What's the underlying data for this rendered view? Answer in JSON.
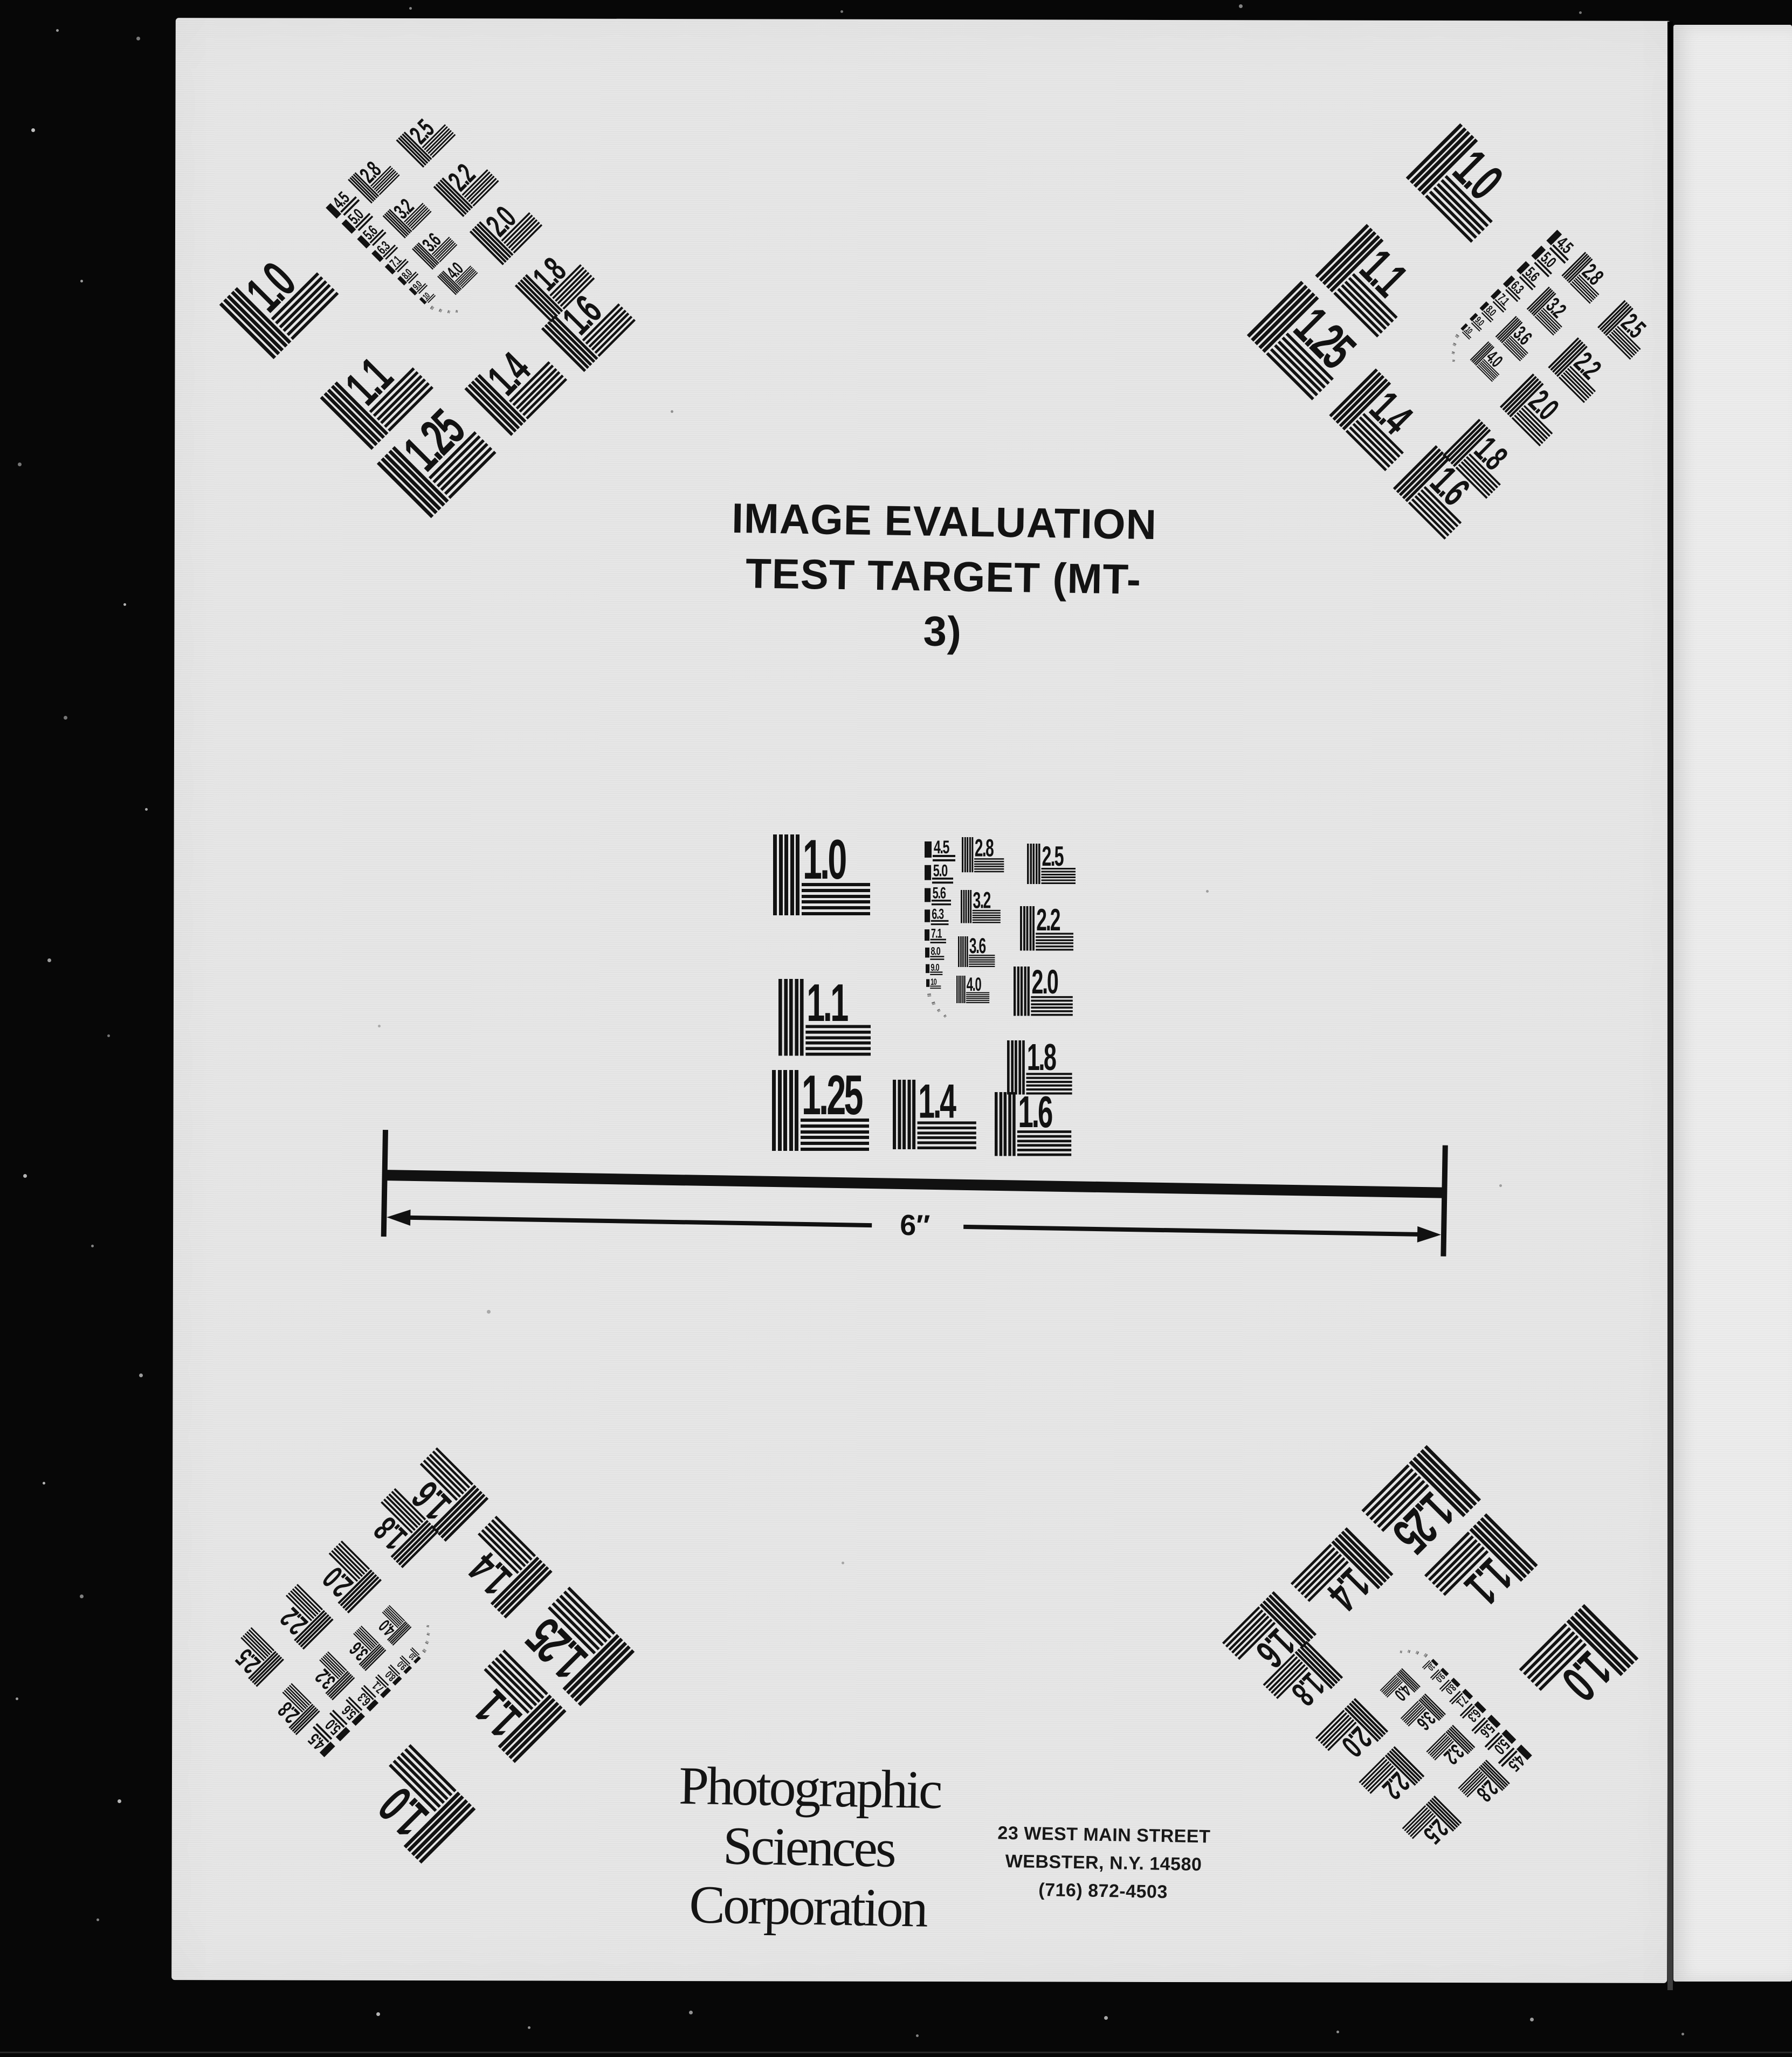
{
  "document": {
    "title_lines": [
      "IMAGE EVALUATION",
      "TEST TARGET (MT-3)"
    ],
    "scale_label": "6″",
    "organization": {
      "name_lines": [
        "Photographic",
        "Sciences",
        "Corporation"
      ],
      "address_lines": [
        "23 WEST MAIN STREET",
        "WEBSTER, N.Y. 14580",
        "(716) 872-4503"
      ]
    }
  },
  "test_pattern": {
    "primary_blocks": [
      "1.0",
      "1.1",
      "1.25",
      "1.4",
      "1.6"
    ],
    "mid_blocks": [
      "2.8",
      "3.2",
      "3.6",
      "4.0"
    ],
    "right_blocks": [
      "2.5",
      "2.2",
      "2.0",
      "1.8"
    ],
    "aperture_steps": [
      "4.5",
      "5.0",
      "5.6",
      "6.3",
      "7.1",
      "8.0",
      "9.0",
      "10"
    ],
    "colors": {
      "ink": "#121212",
      "paper": "#e7e7e7",
      "film_border": "#070707"
    }
  }
}
